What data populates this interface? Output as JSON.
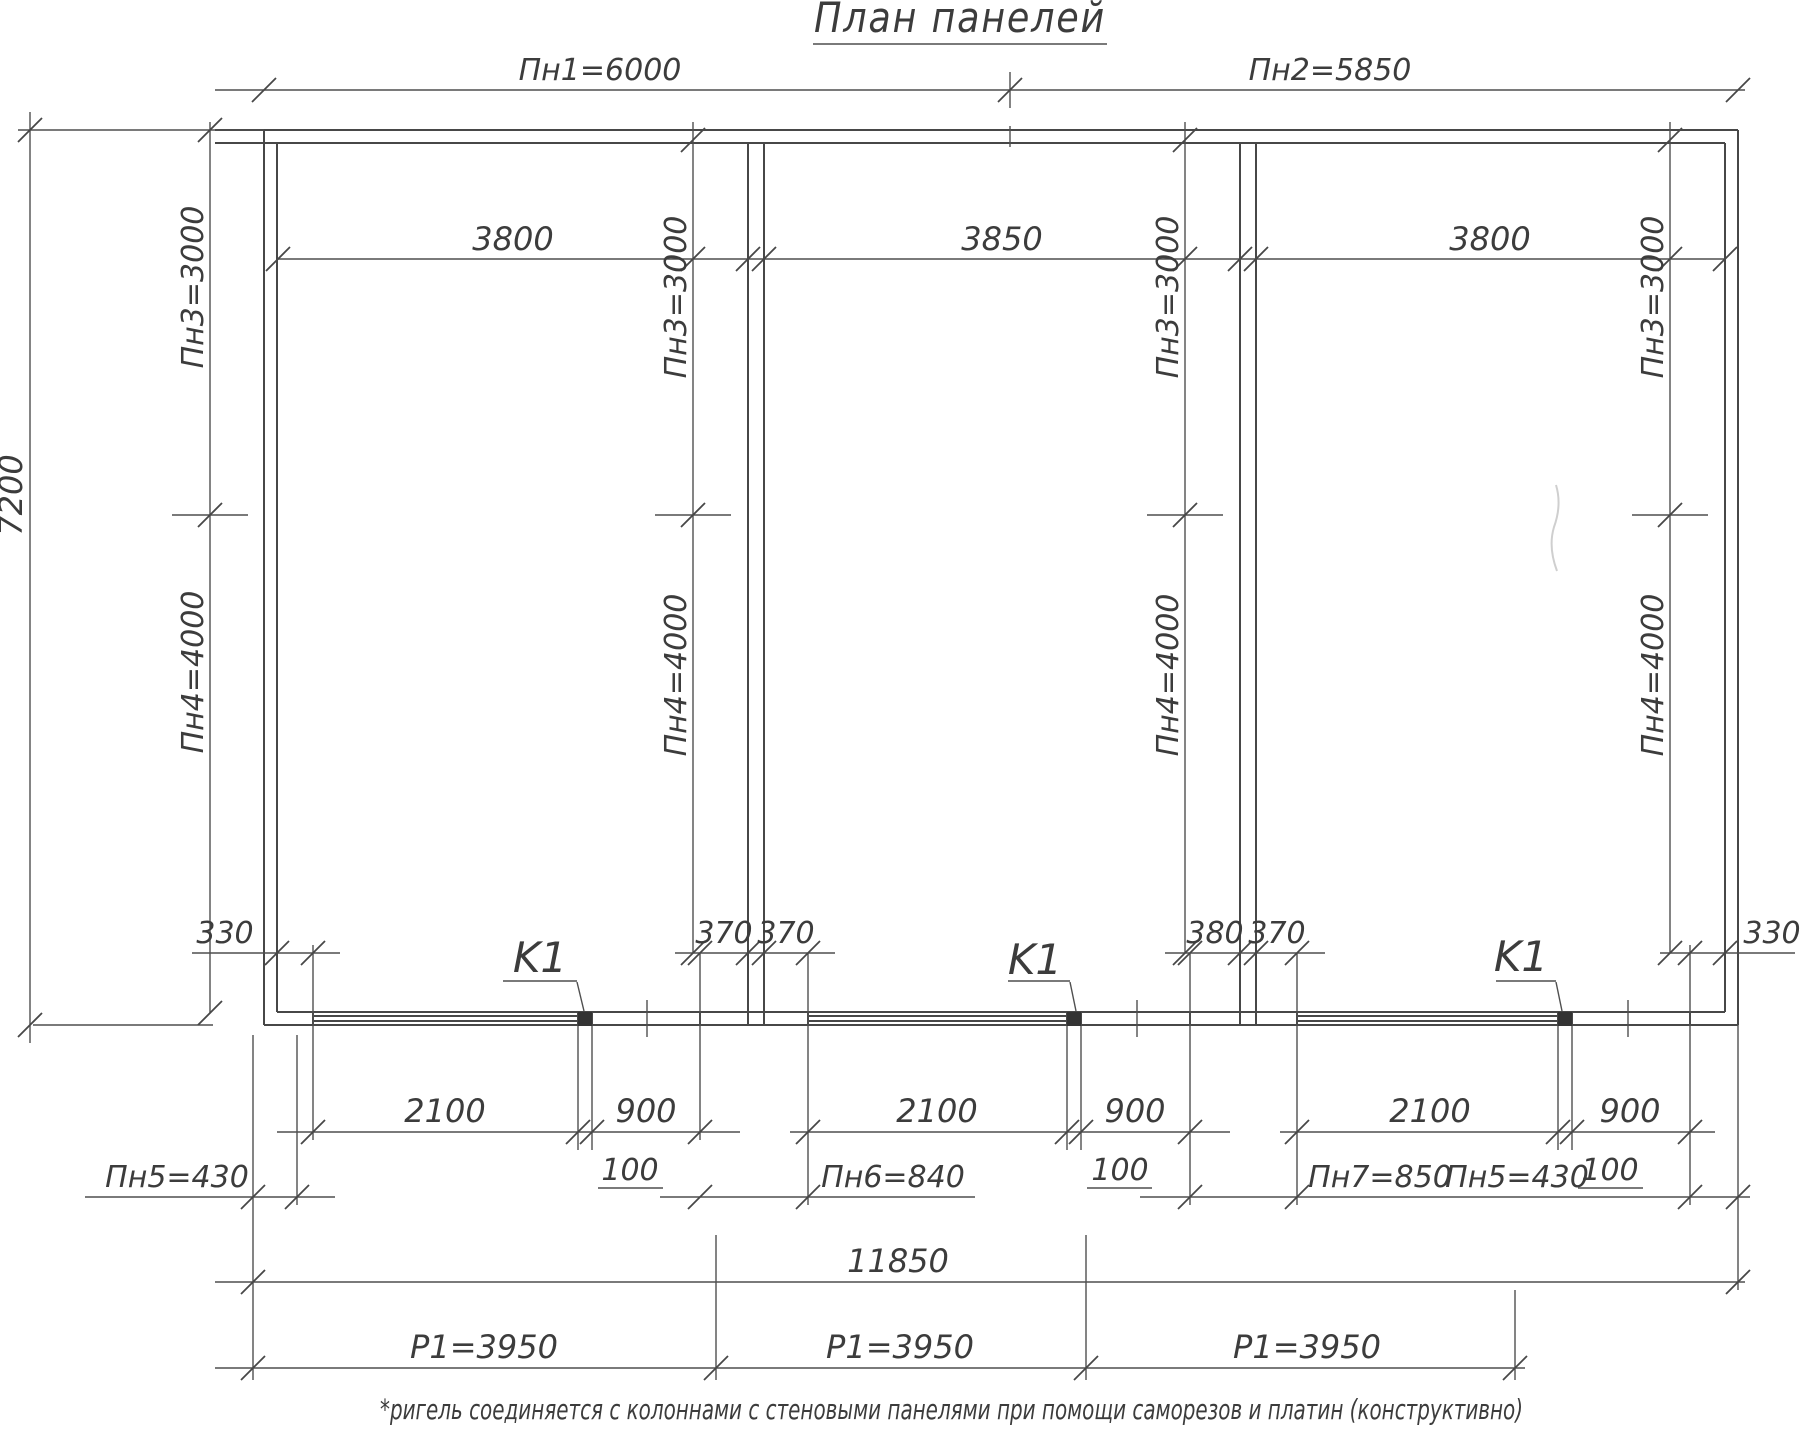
{
  "title": "План панелей",
  "top_dimensions": {
    "pn1": "Пн1=6000",
    "pn2": "Пн2=5850"
  },
  "left_dimensions": {
    "overall_height": "7200",
    "pn3": "Пн3=3000",
    "pn4": "Пн4=4000"
  },
  "bays": [
    {
      "top_width": "3800",
      "pn3": "Пн3=3000",
      "pn4": "Пн4=4000",
      "panel_width": "2100",
      "opening_width": "900",
      "column_offset": "100",
      "column_label": "K1"
    },
    {
      "top_width": "3850",
      "pn3": "Пн3=3000",
      "pn4": "Пн4=4000",
      "panel_width": "2100",
      "opening_width": "900",
      "column_offset": "100",
      "column_label": "K1"
    },
    {
      "top_width": "3800",
      "pn3": "Пн3=3000",
      "pn4": "Пн4=4000",
      "panel_width": "2100",
      "opening_width": "900",
      "column_offset": "100",
      "column_label": "K1"
    }
  ],
  "edge_dimensions": {
    "left_330": "330",
    "d1_left_370": "370",
    "d1_right_370": "370",
    "d2_left_380": "380",
    "d2_right_370": "370",
    "right_330": "330"
  },
  "panel_row": {
    "pn5_left": "Пн5=430",
    "pn6": "Пн6=840",
    "pn7": "Пн7=850",
    "pn5_right": "Пн5=430"
  },
  "totals": {
    "overall_width": "11850",
    "r1_1": "Р1=3950",
    "r1_2": "Р1=3950",
    "r1_3": "Р1=3950"
  },
  "footnote": "*ригель соединяется с колоннами с стеновыми панелями при помощи саморезов и платин (конструктивно)"
}
